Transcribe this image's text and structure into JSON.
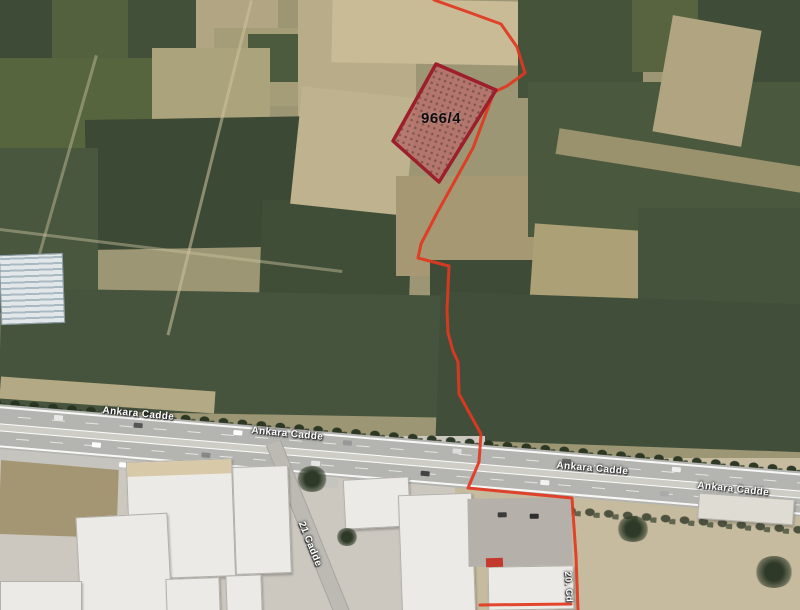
{
  "map": {
    "parcel": {
      "label": "966/4"
    },
    "road_labels": [
      {
        "text": "Ankara Cadde"
      },
      {
        "text": "Ankara Cadde"
      },
      {
        "text": "Ankara Cadde"
      },
      {
        "text": "Ankara Cadde"
      }
    ],
    "side_road_label": {
      "text": "21 Cadde"
    },
    "corner_road_label": {
      "text": "20. Cd"
    }
  },
  "colors": {
    "boundary-red": "#e2371f",
    "parcel-border": "#9c1f2b",
    "parcel-fill": "#b5726c",
    "parcel-dot": "#7e4a49",
    "label-color": "#ffffff"
  }
}
